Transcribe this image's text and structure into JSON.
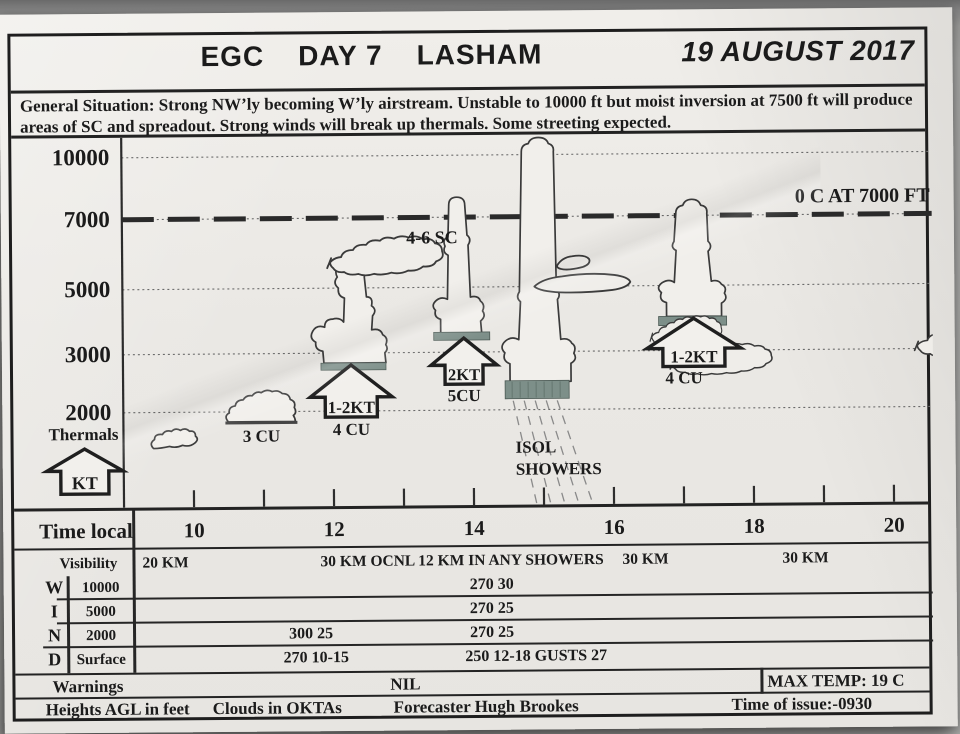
{
  "header": {
    "competition": "EGC",
    "day": "DAY 7",
    "site": "LASHAM",
    "date": "19 AUGUST 2017"
  },
  "general_situation": {
    "label": "General Situation:",
    "text": "Strong NW’ly becoming W’ly airstream. Unstable to 10000 ft but moist inversion at 7500 ft will produce areas of SC and spreadout. Strong winds will break up thermals. Some streeting expected."
  },
  "chart_data": {
    "type": "diagram",
    "title": "Soaring forecast: cloud development and thermal strength vs local time",
    "xlabel": "Time local",
    "ylabel": "Heights AGL in feet",
    "x_ticks": [
      10,
      12,
      14,
      16,
      18,
      20
    ],
    "x_minor_tick_interval_hours": 1,
    "y_tick_labels": [
      "10000",
      "7000",
      "5000",
      "3000",
      "2000"
    ],
    "y_ticks_ft": [
      10000,
      7000,
      5000,
      3000,
      2000
    ],
    "grid": "dotted horizontal line at each labelled height",
    "freezing_level": {
      "label": "0 C AT 7000 FT",
      "height_ft": 7000,
      "line_style": "heavy dashed"
    },
    "spreadout_label": "4-6 SC",
    "showers": {
      "label_lines": [
        "ISOL",
        "SHOWERS"
      ],
      "time_local": 15.3
    },
    "thermals_legend": {
      "label": "Thermals",
      "unit_label": "KT"
    },
    "elements": [
      {
        "type": "cumulus-small",
        "time_local": 10.8,
        "label": "3 CU",
        "base_ft": 2100,
        "top_ft": 2600
      },
      {
        "type": "cumulus",
        "time_local": 12.6,
        "label": "4 CU",
        "thermal_strength": "1-2KT",
        "base_ft": 3300,
        "top_ft": 5400
      },
      {
        "type": "cumulus",
        "time_local": 14.2,
        "label": "5CU",
        "thermal_strength": "2KT",
        "base_ft": 4300,
        "top_ft": 7200
      },
      {
        "type": "cumulonimbus-shower",
        "time_local": 15.3,
        "label": "ISOL SHOWERS",
        "base_ft": 3700,
        "top_ft": 10100
      },
      {
        "type": "cumulus",
        "time_local": 17.5,
        "label": "4 CU",
        "thermal_strength": "1-2KT",
        "base_ft": 4400,
        "top_ft": 7100
      },
      {
        "type": "stratocumulus-layers",
        "time_local_range": [
          12.3,
          18.0
        ],
        "label": "4-6 SC",
        "base_ft": 5400,
        "top_ft": 6300
      }
    ]
  },
  "time_axis": {
    "label": "Time local",
    "hours": [
      "10",
      "12",
      "14",
      "16",
      "18",
      "20"
    ]
  },
  "visibility": {
    "label": "Visibility",
    "values": [
      "20 KM",
      "30 KM OCNL 12 KM IN ANY SHOWERS",
      "30 KM",
      "30 KM"
    ]
  },
  "wind_table": {
    "letters": [
      "W",
      "I",
      "N",
      "D"
    ],
    "rows": [
      {
        "level": "10000",
        "early": "",
        "main": "270 30"
      },
      {
        "level": "5000",
        "early": "",
        "main": "270 25"
      },
      {
        "level": "2000",
        "early": "300 25",
        "main": "270 25"
      },
      {
        "level": "Surface",
        "early": "270 10-15",
        "main": "250 12-18 GUSTS 27"
      }
    ]
  },
  "warnings": {
    "label": "Warnings",
    "value": "NIL"
  },
  "max_temp": "MAX TEMP: 19 C",
  "footer": {
    "heights_note": "Heights AGL in feet",
    "clouds_note": "Clouds in OKTAs",
    "forecaster": "Forecaster Hugh Brookes",
    "issue_time": "Time of issue:-0930"
  }
}
